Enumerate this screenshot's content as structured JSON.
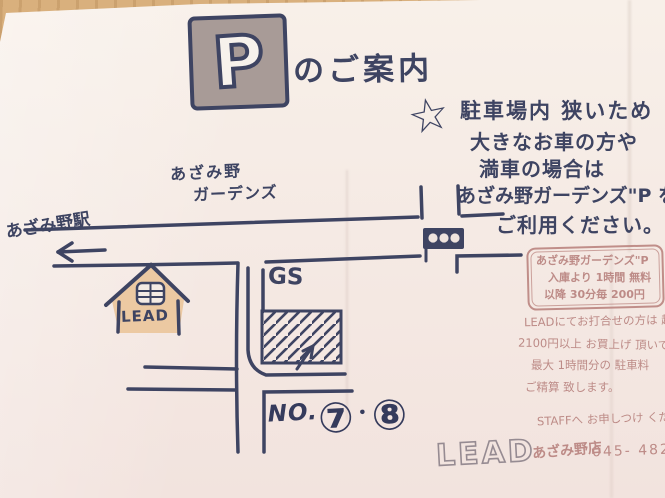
{
  "header": {
    "parking_sign": "P",
    "title": "のご案内"
  },
  "warning_note": {
    "star_glyph": "☆",
    "lines": [
      "駐車場内 狭いため",
      "大きなお車の方や",
      "満車の場合は",
      "あざみ野ガーデンズ\"P を",
      "ご利用ください。"
    ]
  },
  "map": {
    "gardens_label_line1": "あざみ野",
    "gardens_label_line2": "ガーデンズ",
    "station_label": "あざみ野駅",
    "gs_label": "GS",
    "house_label": "LEAD",
    "parking_no": {
      "prefix": "NO.",
      "n1": "⑦",
      "separator": "・",
      "n2": "⑧"
    }
  },
  "info_box": {
    "lines": [
      "あざみ野ガーデンズ\"P",
      "入庫より 1時間 無料",
      "以降 30分毎 200円"
    ]
  },
  "pink_notes": {
    "lines": [
      "LEADにてお打合せの方は 超",
      "2100円以上 お買上げ 頂いて",
      "最大 1時間分の 駐車料",
      "ご精算 致します。",
      "STAFFへ お申しつけ くだ"
    ]
  },
  "footer": {
    "brand": "LEAD",
    "store": "あざみ野店",
    "phone": "045- 482"
  },
  "colors": {
    "ink_navy": "#3e4462",
    "pink_ink": "#bd8b87",
    "paper": "#f5eae4",
    "wood_table": "#d3a975",
    "sign_plate": "#a89b97",
    "house_fill": "#ecc9a2"
  }
}
